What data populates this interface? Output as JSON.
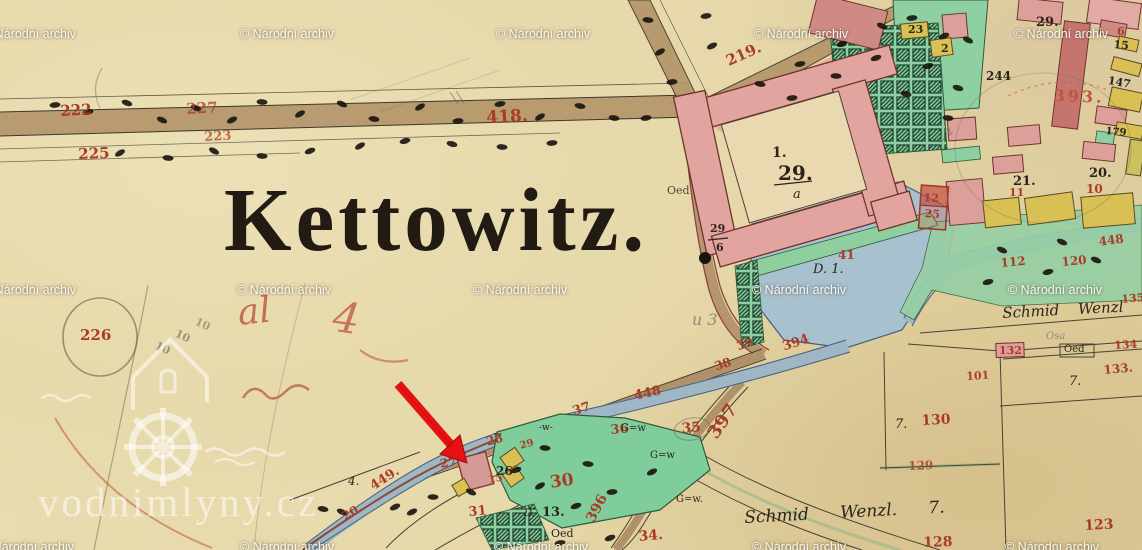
{
  "map": {
    "title": "Kettowitz.",
    "palette": {
      "red": "#a93b27",
      "red2": "#c0543c",
      "ink": "#2b241c",
      "grey": "#7c7260",
      "paper": "#e7dbb0",
      "pink_building": "#dd9f99",
      "yellow_building": "#d9c054",
      "green_garden": "#8fd0a2",
      "water_blue": "#a8c1cf",
      "road_brown": "#b09169",
      "arrow_red": "#e81111",
      "watermark_white": "#ffffff"
    },
    "watermarks": {
      "archive_text": "© Národní archiv",
      "site_text": "vodnimlyny.cz",
      "rows": [
        {
          "y": 27,
          "xs": [
            -18,
            240,
            496,
            754,
            1014
          ]
        },
        {
          "y": 283,
          "xs": [
            -18,
            237,
            473,
            752,
            1008
          ]
        },
        {
          "y": 540,
          "xs": [
            -20,
            240,
            494,
            752,
            1005
          ]
        }
      ]
    },
    "labels": [
      {
        "t": "222",
        "x": 60,
        "y": 104,
        "s": 15,
        "c": "red",
        "r": -3,
        "n": "parcel-number-222"
      },
      {
        "t": "227",
        "x": 186,
        "y": 102,
        "s": 15,
        "c": "red",
        "r": -3,
        "o": 0.75,
        "n": "parcel-number-227"
      },
      {
        "t": "223",
        "x": 204,
        "y": 131,
        "s": 13,
        "c": "red",
        "r": -3,
        "o": 0.7,
        "n": "parcel-number-223"
      },
      {
        "t": "225",
        "x": 78,
        "y": 147,
        "s": 15,
        "c": "red",
        "r": -2,
        "n": "parcel-number-225"
      },
      {
        "t": "418.",
        "x": 486,
        "y": 110,
        "s": 17,
        "c": "red",
        "r": -3,
        "n": "road-number-418"
      },
      {
        "t": "219.",
        "x": 724,
        "y": 55,
        "s": 15,
        "c": "red",
        "r": -24,
        "n": "road-number-219"
      },
      {
        "t": "393.",
        "x": 1054,
        "y": 88,
        "s": 16,
        "c": "red2",
        "r": 2,
        "ls": 3,
        "n": "parcel-number-393"
      },
      {
        "t": "6",
        "x": 1117,
        "y": 26,
        "s": 11,
        "c": "red",
        "n": "parcel-number-6"
      },
      {
        "t": "15",
        "x": 1114,
        "y": 39,
        "s": 11,
        "c": "ink",
        "r": 5,
        "n": "parcel-number-15"
      },
      {
        "t": "29.",
        "x": 1036,
        "y": 16,
        "s": 13,
        "c": "ink",
        "n": "parcel-number-29-top"
      },
      {
        "t": "23",
        "x": 908,
        "y": 24,
        "s": 11,
        "c": "ink",
        "n": "parcel-number-23"
      },
      {
        "t": "2",
        "x": 941,
        "y": 43,
        "s": 11,
        "c": "ink",
        "n": "parcel-number-2"
      },
      {
        "t": "244",
        "x": 986,
        "y": 70,
        "s": 12,
        "c": "ink",
        "n": "parcel-number-244"
      },
      {
        "t": "147",
        "x": 1109,
        "y": 75,
        "s": 11,
        "c": "ink",
        "r": 10,
        "n": "parcel-number-147"
      },
      {
        "t": "179",
        "x": 1106,
        "y": 127,
        "s": 10,
        "c": "ink",
        "r": 5,
        "n": "parcel-number-179"
      },
      {
        "t": "20.",
        "x": 1089,
        "y": 167,
        "s": 13,
        "c": "ink",
        "n": "parcel-number-20"
      },
      {
        "t": "21.",
        "x": 1013,
        "y": 175,
        "s": 13,
        "c": "ink",
        "n": "parcel-number-21"
      },
      {
        "t": "10",
        "x": 1086,
        "y": 183,
        "s": 12,
        "c": "red",
        "n": "parcel-number-10"
      },
      {
        "t": "11",
        "x": 1009,
        "y": 187,
        "s": 11,
        "c": "red",
        "n": "parcel-number-11"
      },
      {
        "t": "1.",
        "x": 772,
        "y": 146,
        "s": 14,
        "c": "ink",
        "n": "building-number-1"
      },
      {
        "t": "29.",
        "x": 778,
        "y": 163,
        "s": 20,
        "c": "ink",
        "n": "building-number-29"
      },
      {
        "t": "a",
        "x": 793,
        "y": 188,
        "s": 13,
        "c": "ink",
        "f": "cur",
        "n": "building-letter-a"
      },
      {
        "t": "29",
        "x": 710,
        "y": 223,
        "s": 11,
        "c": "ink",
        "n": "parcel-fraction-29"
      },
      {
        "t": "6",
        "x": 716,
        "y": 242,
        "s": 11,
        "c": "ink",
        "n": "parcel-fraction-6"
      },
      {
        "t": "Oed",
        "x": 667,
        "y": 185,
        "s": 11,
        "c": "ink",
        "o": 0.8,
        "f": "pl",
        "n": "oed-annotation"
      },
      {
        "t": "41",
        "x": 838,
        "y": 249,
        "s": 12,
        "c": "red",
        "n": "parcel-number-41"
      },
      {
        "t": "D. 1.",
        "x": 813,
        "y": 263,
        "s": 13,
        "c": "ink",
        "f": "cur",
        "n": "pond-label-d1"
      },
      {
        "t": "12",
        "x": 924,
        "y": 192,
        "s": 11,
        "c": "red",
        "r": 4,
        "n": "parcel-number-12"
      },
      {
        "t": "25",
        "x": 925,
        "y": 208,
        "s": 11,
        "c": "red",
        "r": 4,
        "n": "parcel-number-25"
      },
      {
        "t": "112",
        "x": 1000,
        "y": 257,
        "s": 12,
        "c": "red",
        "r": -5,
        "n": "parcel-number-112"
      },
      {
        "t": "120",
        "x": 1061,
        "y": 256,
        "s": 12,
        "c": "red",
        "r": -5,
        "n": "parcel-number-120"
      },
      {
        "t": "448",
        "x": 1098,
        "y": 236,
        "s": 12,
        "c": "red",
        "r": -8,
        "n": "road-number-448-right"
      },
      {
        "t": "135",
        "x": 1121,
        "y": 294,
        "s": 11,
        "c": "red",
        "r": -5,
        "n": "parcel-number-135"
      },
      {
        "t": "Schmid Wenzl",
        "x": 1002,
        "y": 306,
        "s": 15,
        "c": "ink",
        "f": "cur",
        "r": -3,
        "w": 14,
        "n": "owner-name-schmid-wenzl"
      },
      {
        "t": "Osa",
        "x": 1046,
        "y": 332,
        "s": 10,
        "c": "grey",
        "f": "cur",
        "o": 0.7,
        "n": "owner-note"
      },
      {
        "t": "132",
        "x": 999,
        "y": 345,
        "s": 11,
        "c": "red",
        "n": "parcel-number-132"
      },
      {
        "t": "Oed",
        "x": 1064,
        "y": 345,
        "s": 10,
        "c": "ink",
        "f": "pl",
        "n": "oed-annotation-2"
      },
      {
        "t": "134",
        "x": 1114,
        "y": 340,
        "s": 11,
        "c": "red",
        "r": -3,
        "n": "parcel-number-134"
      },
      {
        "t": "133.",
        "x": 1103,
        "y": 364,
        "s": 12,
        "c": "red",
        "r": -5,
        "n": "parcel-number-133"
      },
      {
        "t": "101",
        "x": 966,
        "y": 371,
        "s": 11,
        "c": "red",
        "r": -3,
        "n": "parcel-number-101"
      },
      {
        "t": "7.",
        "x": 1069,
        "y": 375,
        "s": 13,
        "c": "ink",
        "f": "cur",
        "n": "field-mark-7a"
      },
      {
        "t": "7.",
        "x": 895,
        "y": 418,
        "s": 13,
        "c": "ink",
        "f": "cur",
        "n": "field-mark-7b"
      },
      {
        "t": "130",
        "x": 921,
        "y": 414,
        "s": 14,
        "c": "red",
        "r": -3,
        "n": "parcel-number-130"
      },
      {
        "t": "129",
        "x": 908,
        "y": 460,
        "s": 12,
        "c": "red",
        "o": 0.8,
        "r": -2,
        "n": "parcel-number-129"
      },
      {
        "t": "123",
        "x": 1084,
        "y": 519,
        "s": 14,
        "c": "red",
        "r": -3,
        "n": "parcel-number-123"
      },
      {
        "t": "128",
        "x": 923,
        "y": 536,
        "s": 14,
        "c": "red",
        "r": -2,
        "n": "parcel-number-128"
      },
      {
        "t": "Schmid  Wenzl. 7.",
        "x": 744,
        "y": 510,
        "s": 17,
        "c": "ink",
        "f": "cur",
        "r": -3,
        "w": 26,
        "n": "owner-name-schmid-wenzl-2"
      },
      {
        "t": "u 3",
        "x": 692,
        "y": 312,
        "s": 16,
        "c": "grey",
        "f": "cur",
        "o": 0.75,
        "n": "pencil-note-u3"
      },
      {
        "t": "39",
        "x": 735,
        "y": 341,
        "s": 12,
        "c": "red",
        "r": -20,
        "n": "parcel-number-39"
      },
      {
        "t": "394",
        "x": 781,
        "y": 341,
        "s": 13,
        "c": "red",
        "r": -18,
        "n": "road-number-394"
      },
      {
        "t": "38",
        "x": 713,
        "y": 361,
        "s": 12,
        "c": "red",
        "r": -18,
        "n": "parcel-number-38"
      },
      {
        "t": "448",
        "x": 633,
        "y": 390,
        "s": 13,
        "c": "red",
        "r": -12,
        "n": "road-number-448"
      },
      {
        "t": "37",
        "x": 571,
        "y": 406,
        "s": 13,
        "c": "red",
        "r": -18,
        "n": "parcel-number-37"
      },
      {
        "t": "36",
        "x": 610,
        "y": 424,
        "s": 13,
        "c": "red",
        "r": -5,
        "n": "parcel-number-36"
      },
      {
        "t": "35",
        "x": 681,
        "y": 422,
        "s": 14,
        "c": "red",
        "r": -5,
        "n": "parcel-number-35"
      },
      {
        "t": "397",
        "x": 705,
        "y": 432,
        "s": 18,
        "c": "red",
        "r": -55,
        "n": "road-number-397"
      },
      {
        "t": "G=w",
        "x": 621,
        "y": 424,
        "s": 10,
        "c": "ink",
        "f": "pl",
        "n": "gw-mark-1"
      },
      {
        "t": "G=w",
        "x": 650,
        "y": 451,
        "s": 10,
        "c": "ink",
        "f": "pl",
        "n": "gw-mark-2"
      },
      {
        "t": "G=w.",
        "x": 676,
        "y": 495,
        "s": 10,
        "c": "ink",
        "f": "pl",
        "n": "gw-mark-3"
      },
      {
        "t": "-w-",
        "x": 539,
        "y": 424,
        "s": 9,
        "c": "ink",
        "f": "pl",
        "n": "w-mark-1"
      },
      {
        "t": "w",
        "x": 494,
        "y": 432,
        "s": 9,
        "c": "ink",
        "f": "pl",
        "n": "w-mark-2"
      },
      {
        "t": "30",
        "x": 549,
        "y": 475,
        "s": 17,
        "c": "red",
        "r": -8,
        "n": "parcel-number-30"
      },
      {
        "t": "D.",
        "x": 524,
        "y": 509,
        "s": 10,
        "c": "ink",
        "f": "cur",
        "n": "parcel-letter-d"
      },
      {
        "t": "13.",
        "x": 542,
        "y": 506,
        "s": 13,
        "c": "ink",
        "n": "parcel-number-13"
      },
      {
        "t": "Oed",
        "x": 551,
        "y": 528,
        "s": 11,
        "c": "ink",
        "f": "pl",
        "n": "oed-annotation-3"
      },
      {
        "t": "396",
        "x": 584,
        "y": 518,
        "s": 14,
        "c": "red",
        "r": -62,
        "n": "road-number-396"
      },
      {
        "t": "34.",
        "x": 638,
        "y": 530,
        "s": 14,
        "c": "red",
        "r": -5,
        "n": "parcel-number-34"
      },
      {
        "t": "31",
        "x": 468,
        "y": 506,
        "s": 13,
        "c": "red",
        "r": -5,
        "n": "parcel-number-31"
      },
      {
        "t": "449.",
        "x": 368,
        "y": 482,
        "s": 13,
        "c": "red",
        "r": -33,
        "n": "road-number-449"
      },
      {
        "t": "20.",
        "x": 340,
        "y": 512,
        "s": 12,
        "c": "red",
        "r": -30,
        "n": "parcel-number-20b"
      },
      {
        "t": "4.",
        "x": 348,
        "y": 475,
        "s": 12,
        "c": "ink",
        "f": "cur",
        "n": "pen-mark-4"
      },
      {
        "t": "27",
        "x": 439,
        "y": 458,
        "s": 12,
        "c": "red",
        "r": -10,
        "n": "parcel-number-27"
      },
      {
        "t": "28",
        "x": 485,
        "y": 436,
        "s": 12,
        "c": "red",
        "r": -15,
        "n": "parcel-number-28"
      },
      {
        "t": "29",
        "x": 519,
        "y": 442,
        "s": 10,
        "c": "red",
        "r": -15,
        "n": "parcel-number-29b"
      },
      {
        "t": "15",
        "x": 488,
        "y": 476,
        "s": 10,
        "c": "red",
        "r": -10,
        "n": "parcel-number-15b"
      },
      {
        "t": "26",
        "x": 496,
        "y": 465,
        "s": 12,
        "c": "ink",
        "n": "parcel-number-26"
      },
      {
        "t": "226",
        "x": 80,
        "y": 328,
        "s": 15,
        "c": "red",
        "n": "parcel-number-226"
      },
      {
        "t": "al",
        "x": 236,
        "y": 296,
        "s": 36,
        "c": "red2",
        "f": "cur",
        "r": -6,
        "o": 0.8,
        "n": "red-scrawl-al"
      },
      {
        "t": "4",
        "x": 336,
        "y": 296,
        "s": 42,
        "c": "red2",
        "f": "cur",
        "r": 8,
        "o": 0.75,
        "n": "red-scrawl-4"
      },
      {
        "t": "10",
        "x": 158,
        "y": 340,
        "s": 11,
        "c": "grey",
        "r": 25,
        "o": 0.7,
        "n": "pencil-10a"
      },
      {
        "t": "10",
        "x": 178,
        "y": 328,
        "s": 11,
        "c": "grey",
        "r": 25,
        "o": 0.7,
        "n": "pencil-10b"
      },
      {
        "t": "10",
        "x": 198,
        "y": 316,
        "s": 11,
        "c": "grey",
        "r": 25,
        "o": 0.6,
        "n": "pencil-10c"
      },
      {
        "t": "2 2",
        "x": 936,
        "y": 138,
        "s": 10,
        "c": "grey",
        "r": -40,
        "o": 0.6,
        "n": "pencil-22"
      }
    ]
  }
}
